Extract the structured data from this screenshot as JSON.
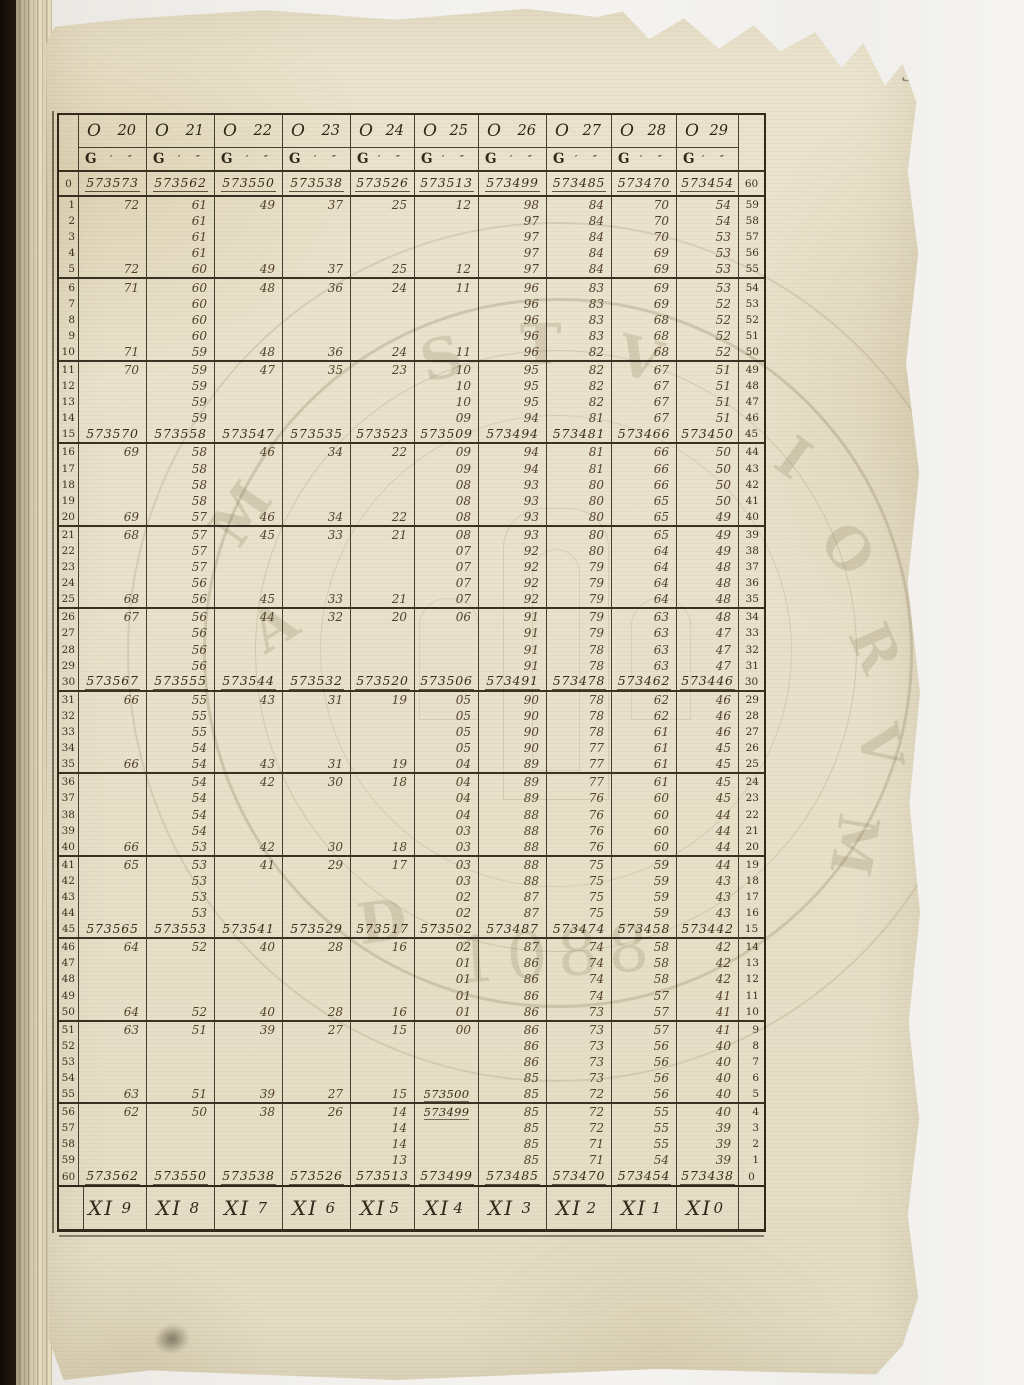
{
  "page": {
    "number": "3"
  },
  "colors": {
    "paper": "#e8e1cb",
    "ink_dark": "#2e2414",
    "ink_entry": "#53402b",
    "binding": "#17100a",
    "stamp": "#8b7c5e"
  },
  "table": {
    "columns": [
      {
        "sign": "O",
        "degree": "20"
      },
      {
        "sign": "O",
        "degree": "21"
      },
      {
        "sign": "O",
        "degree": "22"
      },
      {
        "sign": "O",
        "degree": "23"
      },
      {
        "sign": "O",
        "degree": "24"
      },
      {
        "sign": "O",
        "degree": "25"
      },
      {
        "sign": "O",
        "degree": "26"
      },
      {
        "sign": "O",
        "degree": "27"
      },
      {
        "sign": "O",
        "degree": "28"
      },
      {
        "sign": "O",
        "degree": "29"
      }
    ],
    "subheader": {
      "label": "G",
      "marks": "′ ″"
    },
    "footer": [
      {
        "sign": "XI",
        "degree": "9"
      },
      {
        "sign": "XI",
        "degree": "8"
      },
      {
        "sign": "XI",
        "degree": "7"
      },
      {
        "sign": "XI",
        "degree": "6"
      },
      {
        "sign": "XI",
        "degree": "5"
      },
      {
        "sign": "XI",
        "degree": "4"
      },
      {
        "sign": "XI",
        "degree": "3"
      },
      {
        "sign": "XI",
        "degree": "2"
      },
      {
        "sign": "XI",
        "degree": "1"
      },
      {
        "sign": "XI",
        "degree": "0"
      }
    ],
    "rows": [
      {
        "l": "0",
        "r": "60",
        "full": true,
        "c": [
          "573573",
          "573562",
          "573550",
          "573538",
          "573526",
          "573513",
          "573499",
          "573485",
          "573470",
          "573454"
        ]
      },
      {
        "l": "1",
        "r": "59",
        "c": [
          "72",
          "61",
          "49",
          "37",
          "25",
          "12",
          "98",
          "84",
          "70",
          "54"
        ]
      },
      {
        "l": "2",
        "r": "58",
        "c": [
          "",
          "61",
          "",
          "",
          "",
          "",
          "97",
          "84",
          "70",
          "54"
        ]
      },
      {
        "l": "3",
        "r": "57",
        "c": [
          "",
          "61",
          "",
          "",
          "",
          "",
          "97",
          "84",
          "70",
          "53"
        ]
      },
      {
        "l": "4",
        "r": "56",
        "c": [
          "",
          "61",
          "",
          "",
          "",
          "",
          "97",
          "84",
          "69",
          "53"
        ]
      },
      {
        "l": "5",
        "r": "55",
        "c": [
          "72",
          "60",
          "49",
          "37",
          "25",
          "12",
          "97",
          "84",
          "69",
          "53"
        ]
      },
      {
        "l": "6",
        "r": "54",
        "c": [
          "71",
          "60",
          "48",
          "36",
          "24",
          "11",
          "96",
          "83",
          "69",
          "53"
        ]
      },
      {
        "l": "7",
        "r": "53",
        "c": [
          "",
          "60",
          "",
          "",
          "",
          "",
          "96",
          "83",
          "69",
          "52"
        ]
      },
      {
        "l": "8",
        "r": "52",
        "c": [
          "",
          "60",
          "",
          "",
          "",
          "",
          "96",
          "83",
          "68",
          "52"
        ]
      },
      {
        "l": "9",
        "r": "51",
        "c": [
          "",
          "60",
          "",
          "",
          "",
          "",
          "96",
          "83",
          "68",
          "52"
        ]
      },
      {
        "l": "10",
        "r": "50",
        "c": [
          "71",
          "59",
          "48",
          "36",
          "24",
          "11",
          "96",
          "82",
          "68",
          "52"
        ]
      },
      {
        "l": "11",
        "r": "49",
        "c": [
          "70",
          "59",
          "47",
          "35",
          "23",
          "10",
          "95",
          "82",
          "67",
          "51"
        ]
      },
      {
        "l": "12",
        "r": "48",
        "c": [
          "",
          "59",
          "",
          "",
          "",
          "10",
          "95",
          "82",
          "67",
          "51"
        ]
      },
      {
        "l": "13",
        "r": "47",
        "c": [
          "",
          "59",
          "",
          "",
          "",
          "10",
          "95",
          "82",
          "67",
          "51"
        ]
      },
      {
        "l": "14",
        "r": "46",
        "c": [
          "",
          "59",
          "",
          "",
          "",
          "09",
          "94",
          "81",
          "67",
          "51"
        ]
      },
      {
        "l": "15",
        "r": "45",
        "full": true,
        "c": [
          "573570",
          "573558",
          "573547",
          "573535",
          "573523",
          "573509",
          "573494",
          "573481",
          "573466",
          "573450"
        ]
      },
      {
        "l": "16",
        "r": "44",
        "c": [
          "69",
          "58",
          "46",
          "34",
          "22",
          "09",
          "94",
          "81",
          "66",
          "50"
        ]
      },
      {
        "l": "17",
        "r": "43",
        "c": [
          "",
          "58",
          "",
          "",
          "",
          "09",
          "94",
          "81",
          "66",
          "50"
        ]
      },
      {
        "l": "18",
        "r": "42",
        "c": [
          "",
          "58",
          "",
          "",
          "",
          "08",
          "93",
          "80",
          "66",
          "50"
        ]
      },
      {
        "l": "19",
        "r": "41",
        "c": [
          "",
          "58",
          "",
          "",
          "",
          "08",
          "93",
          "80",
          "65",
          "50"
        ]
      },
      {
        "l": "20",
        "r": "40",
        "c": [
          "69",
          "57",
          "46",
          "34",
          "22",
          "08",
          "93",
          "80",
          "65",
          "49"
        ]
      },
      {
        "l": "21",
        "r": "39",
        "c": [
          "68",
          "57",
          "45",
          "33",
          "21",
          "08",
          "93",
          "80",
          "65",
          "49"
        ]
      },
      {
        "l": "22",
        "r": "38",
        "c": [
          "",
          "57",
          "",
          "",
          "",
          "07",
          "92",
          "80",
          "64",
          "49"
        ]
      },
      {
        "l": "23",
        "r": "37",
        "c": [
          "",
          "57",
          "",
          "",
          "",
          "07",
          "92",
          "79",
          "64",
          "48"
        ]
      },
      {
        "l": "24",
        "r": "36",
        "c": [
          "",
          "56",
          "",
          "",
          "",
          "07",
          "92",
          "79",
          "64",
          "48"
        ]
      },
      {
        "l": "25",
        "r": "35",
        "c": [
          "68",
          "56",
          "45",
          "33",
          "21",
          "07",
          "92",
          "79",
          "64",
          "48"
        ]
      },
      {
        "l": "26",
        "r": "34",
        "c": [
          "67",
          "56",
          "44",
          "32",
          "20",
          "06",
          "91",
          "79",
          "63",
          "48"
        ]
      },
      {
        "l": "27",
        "r": "33",
        "c": [
          "",
          "56",
          "",
          "",
          "",
          "",
          "91",
          "79",
          "63",
          "47"
        ]
      },
      {
        "l": "28",
        "r": "32",
        "c": [
          "",
          "56",
          "",
          "",
          "",
          "",
          "91",
          "78",
          "63",
          "47"
        ]
      },
      {
        "l": "29",
        "r": "31",
        "c": [
          "",
          "56",
          "",
          "",
          "",
          "",
          "91",
          "78",
          "63",
          "47"
        ]
      },
      {
        "l": "30",
        "r": "30",
        "full": true,
        "c": [
          "573567",
          "573555",
          "573544",
          "573532",
          "573520",
          "573506",
          "573491",
          "573478",
          "573462",
          "573446"
        ]
      },
      {
        "l": "31",
        "r": "29",
        "c": [
          "66",
          "55",
          "43",
          "31",
          "19",
          "05",
          "90",
          "78",
          "62",
          "46"
        ]
      },
      {
        "l": "32",
        "r": "28",
        "c": [
          "",
          "55",
          "",
          "",
          "",
          "05",
          "90",
          "78",
          "62",
          "46"
        ]
      },
      {
        "l": "33",
        "r": "27",
        "c": [
          "",
          "55",
          "",
          "",
          "",
          "05",
          "90",
          "78",
          "61",
          "46"
        ]
      },
      {
        "l": "34",
        "r": "26",
        "c": [
          "",
          "54",
          "",
          "",
          "",
          "05",
          "90",
          "77",
          "61",
          "45"
        ]
      },
      {
        "l": "35",
        "r": "25",
        "c": [
          "66",
          "54",
          "43",
          "31",
          "19",
          "04",
          "89",
          "77",
          "61",
          "45"
        ]
      },
      {
        "l": "36",
        "r": "24",
        "c": [
          "",
          "54",
          "42",
          "30",
          "18",
          "04",
          "89",
          "77",
          "61",
          "45"
        ]
      },
      {
        "l": "37",
        "r": "23",
        "c": [
          "",
          "54",
          "",
          "",
          "",
          "04",
          "89",
          "76",
          "60",
          "45"
        ]
      },
      {
        "l": "38",
        "r": "22",
        "c": [
          "",
          "54",
          "",
          "",
          "",
          "04",
          "88",
          "76",
          "60",
          "44"
        ]
      },
      {
        "l": "39",
        "r": "21",
        "c": [
          "",
          "54",
          "",
          "",
          "",
          "03",
          "88",
          "76",
          "60",
          "44"
        ]
      },
      {
        "l": "40",
        "r": "20",
        "c": [
          "66",
          "53",
          "42",
          "30",
          "18",
          "03",
          "88",
          "76",
          "60",
          "44"
        ]
      },
      {
        "l": "41",
        "r": "19",
        "c": [
          "65",
          "53",
          "41",
          "29",
          "17",
          "03",
          "88",
          "75",
          "59",
          "44"
        ]
      },
      {
        "l": "42",
        "r": "18",
        "c": [
          "",
          "53",
          "",
          "",
          "",
          "03",
          "88",
          "75",
          "59",
          "43"
        ]
      },
      {
        "l": "43",
        "r": "17",
        "c": [
          "",
          "53",
          "",
          "",
          "",
          "02",
          "87",
          "75",
          "59",
          "43"
        ]
      },
      {
        "l": "44",
        "r": "16",
        "c": [
          "",
          "53",
          "",
          "",
          "",
          "02",
          "87",
          "75",
          "59",
          "43"
        ]
      },
      {
        "l": "45",
        "r": "15",
        "full": true,
        "c": [
          "573565",
          "573553",
          "573541",
          "573529",
          "573517",
          "573502",
          "573487",
          "573474",
          "573458",
          "573442"
        ]
      },
      {
        "l": "46",
        "r": "14",
        "c": [
          "64",
          "52",
          "40",
          "28",
          "16",
          "02",
          "87",
          "74",
          "58",
          "42"
        ]
      },
      {
        "l": "47",
        "r": "13",
        "c": [
          "",
          "",
          "",
          "",
          "",
          "01",
          "86",
          "74",
          "58",
          "42"
        ]
      },
      {
        "l": "48",
        "r": "12",
        "c": [
          "",
          "",
          "",
          "",
          "",
          "01",
          "86",
          "74",
          "58",
          "42"
        ]
      },
      {
        "l": "49",
        "r": "11",
        "c": [
          "",
          "",
          "",
          "",
          "",
          "01",
          "86",
          "74",
          "57",
          "41"
        ]
      },
      {
        "l": "50",
        "r": "10",
        "c": [
          "64",
          "52",
          "40",
          "28",
          "16",
          "01",
          "86",
          "73",
          "57",
          "41"
        ]
      },
      {
        "l": "51",
        "r": "9",
        "c": [
          "63",
          "51",
          "39",
          "27",
          "15",
          "00",
          "86",
          "73",
          "57",
          "41"
        ]
      },
      {
        "l": "52",
        "r": "8",
        "c": [
          "",
          "",
          "",
          "",
          "",
          "",
          "86",
          "73",
          "56",
          "40"
        ]
      },
      {
        "l": "53",
        "r": "7",
        "c": [
          "",
          "",
          "",
          "",
          "",
          "",
          "86",
          "73",
          "56",
          "40"
        ]
      },
      {
        "l": "54",
        "r": "6",
        "c": [
          "",
          "",
          "",
          "",
          "",
          "",
          "85",
          "73",
          "56",
          "40"
        ]
      },
      {
        "l": "55",
        "r": "5",
        "c": [
          "63",
          "51",
          "39",
          "27",
          "15",
          "573500",
          "85",
          "72",
          "56",
          "40"
        ]
      },
      {
        "l": "56",
        "r": "4",
        "c": [
          "62",
          "50",
          "38",
          "26",
          "14",
          "573499",
          "85",
          "72",
          "55",
          "40"
        ]
      },
      {
        "l": "57",
        "r": "3",
        "c": [
          "",
          "",
          "",
          "",
          "14",
          "",
          "85",
          "72",
          "55",
          "39"
        ]
      },
      {
        "l": "58",
        "r": "2",
        "c": [
          "",
          "",
          "",
          "",
          "14",
          "",
          "85",
          "71",
          "55",
          "39"
        ]
      },
      {
        "l": "59",
        "r": "1",
        "c": [
          "",
          "",
          "",
          "",
          "13",
          "",
          "85",
          "71",
          "54",
          "39"
        ]
      },
      {
        "l": "60",
        "r": "0",
        "full": true,
        "c": [
          "573562",
          "573550",
          "573538",
          "573526",
          "573513",
          "573499",
          "573485",
          "573470",
          "573454",
          "573438"
        ]
      }
    ]
  },
  "watermark": {
    "glyphs": [
      {
        "ch": "M",
        "x": 1,
        "y": 26,
        "r": -55
      },
      {
        "ch": "A",
        "x": 7,
        "y": 42,
        "r": -32
      },
      {
        "ch": "S",
        "x": 31,
        "y": 4,
        "r": -14
      },
      {
        "ch": "T",
        "x": 45,
        "y": 2,
        "r": 0
      },
      {
        "ch": "V",
        "x": 59,
        "y": 4,
        "r": 14
      },
      {
        "ch": "I",
        "x": 82,
        "y": 18,
        "r": 36
      },
      {
        "ch": "O",
        "x": 88,
        "y": 31,
        "r": 52
      },
      {
        "ch": "R",
        "x": 92,
        "y": 45,
        "r": 66
      },
      {
        "ch": "V",
        "x": 93,
        "y": 59,
        "r": 80
      },
      {
        "ch": "M",
        "x": 88,
        "y": 73,
        "r": 100
      },
      {
        "ch": "D",
        "x": 22,
        "y": 84,
        "r": -8
      },
      {
        "ch": "1088",
        "x": 36,
        "y": 88,
        "r": -4,
        "big": true
      }
    ]
  }
}
